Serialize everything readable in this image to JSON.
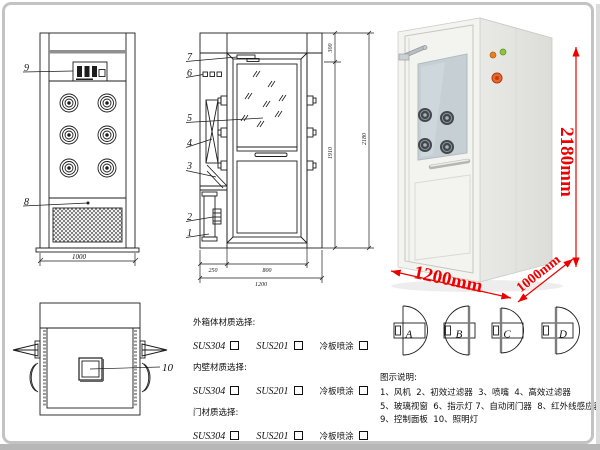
{
  "drawings": {
    "front_view": {
      "callouts": {
        "control_panel": "9",
        "infrared_sensor": "8"
      },
      "dim_width": "1000"
    },
    "side_view": {
      "callouts": [
        "7",
        "6",
        "5",
        "4",
        "3",
        "2",
        "1"
      ],
      "dims": {
        "top": "300",
        "door_height": "1910",
        "total_height": "2180",
        "left_depth": "250",
        "door_width": "800",
        "total_width": "1200"
      }
    },
    "top_view": {
      "callout_light": "10"
    }
  },
  "photo": {
    "dim_height": "2180mm",
    "dim_width": "1200mm",
    "dim_depth": "1000mm",
    "accent_color": "#ee0000"
  },
  "materials": {
    "groups": [
      {
        "label": "外箱体材质选择:",
        "options": [
          "SUS304",
          "SUS201",
          "冷板喷涂"
        ]
      },
      {
        "label": "内壁材质选择:",
        "options": [
          "SUS304",
          "SUS201",
          "冷板喷涂"
        ]
      },
      {
        "label": "门材质选择:",
        "options": [
          "SUS304",
          "SUS201",
          "冷板喷涂"
        ]
      }
    ]
  },
  "door_options": [
    "A",
    "B",
    "C",
    "D"
  ],
  "legend": {
    "title": "图示说明:",
    "lines": [
      "1、风机  2、初效过滤器  3、喷嘴  4、高效过滤器",
      "5、玻璃视窗  6、指示灯 7、自动闭门器  8、红外线感应器",
      "9、控制面板  10、照明灯"
    ]
  }
}
